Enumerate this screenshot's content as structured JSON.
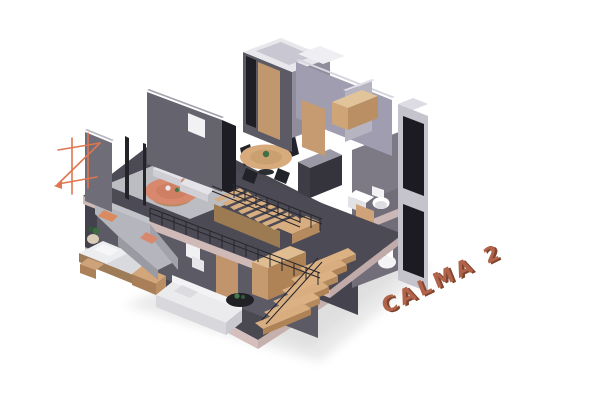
{
  "title_3d": {
    "text": "CALMA 2",
    "face_color": "#b2644a",
    "side_color": "#7f452f"
  },
  "branding": {
    "logo_icon": "architect-monogram-icon",
    "logo_color": "#e0764f"
  },
  "palette": {
    "background": "#ffffff",
    "wall_dark": "#55545e",
    "wall_darker": "#45444e",
    "wall_mid": "#6a6974",
    "wall_lavender": "#a7a4b4",
    "wall_lavender_light": "#dcdae2",
    "floor_dark": "#4a4952",
    "slab_pink": "#d5bfbd",
    "wood_light": "#d9b183",
    "wood_mid": "#c59a6f",
    "wood_dark": "#a57f55",
    "sofa_white": "#ebebee",
    "sofa_gray": "#b5b5bd",
    "accent_salmon": "#d8886c",
    "plant_green": "#2f5a36",
    "glass_black": "#1d1d23"
  },
  "description": "Isometric cutaway render of the two-story CALMA 2 apartment: upper floor with lounge, armchairs, plant, round dining table and bathroom block; lower floor with bedroom, white sofa, wooden staircase and stacked bathrooms."
}
